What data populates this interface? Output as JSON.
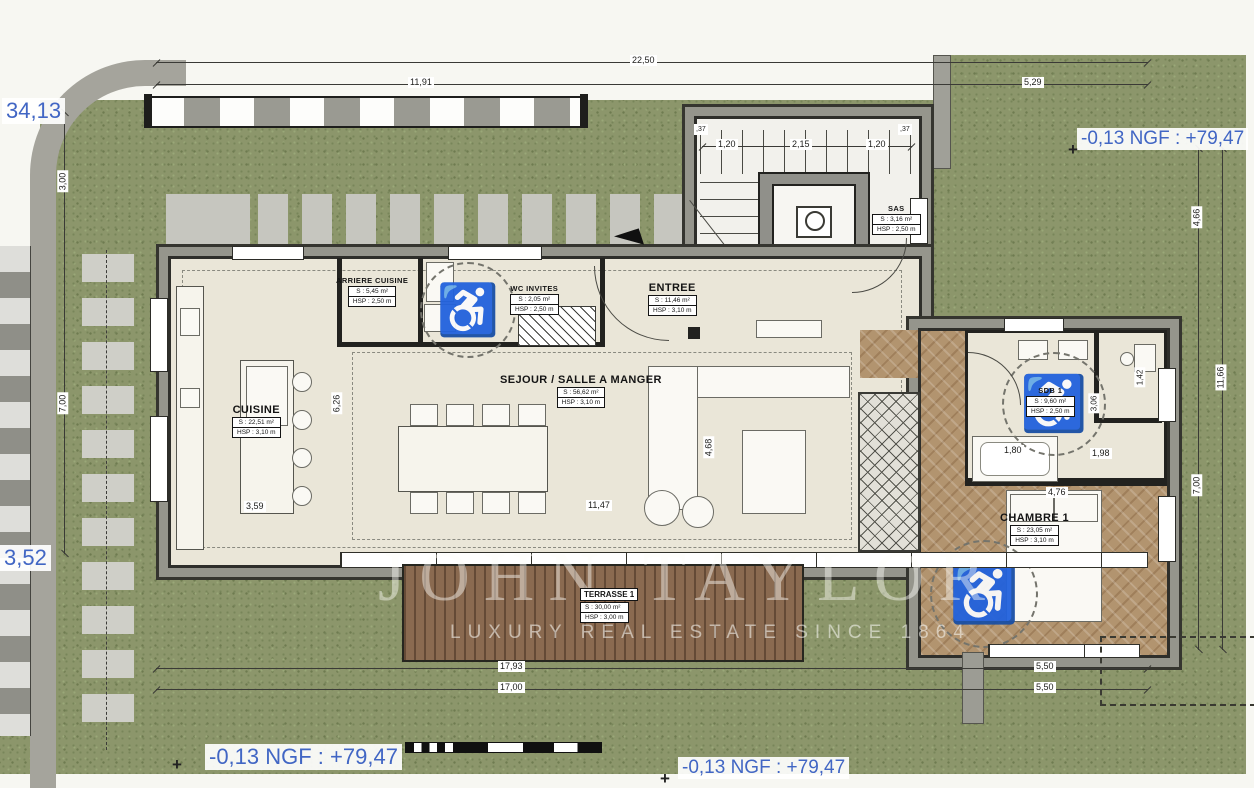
{
  "watermark": {
    "brand": "JOHN TAYLOR",
    "tagline": "LUXURY REAL ESTATE SINCE 1864"
  },
  "elevation": {
    "top_right": "-0,13 NGF : +79,47",
    "bottom_left": "-0,13 NGF : +79,47",
    "bottom_right": "-0,13 NGF : +79,47"
  },
  "boundary": {
    "left_top": "34,13",
    "left_bottom": "3,52"
  },
  "rooms": {
    "arriere_cuisine": {
      "name": "ARRIERE CUISINE",
      "area": "S : 5,45 m²",
      "hsp": "HSP : 2,50 m"
    },
    "wc_invites": {
      "name": "WC INVITES",
      "area": "S : 2,05 m²",
      "hsp": "HSP : 2,50 m"
    },
    "entree": {
      "name": "ENTREE",
      "area": "S : 11,46 m²",
      "hsp": "HSP : 3,10 m"
    },
    "sas": {
      "name": "SAS",
      "area": "S : 3,16 m²",
      "hsp": "HSP : 2,50 m"
    },
    "cuisine": {
      "name": "CUISINE",
      "area": "S : 22,51 m²",
      "hsp": "HSP : 3,10 m"
    },
    "sejour": {
      "name": "SEJOUR / SALLE A MANGER",
      "area": "S : 56,62 m²",
      "hsp": "HSP : 3,10 m"
    },
    "sdb1": {
      "name": "SDB 1",
      "area": "S : 9,60 m²",
      "hsp": "HSP : 2,50 m"
    },
    "chambre1": {
      "name": "CHAMBRE 1",
      "area": "S : 23,05 m²",
      "hsp": "HSP : 3,10 m"
    },
    "terrasse1": {
      "name": "TERRASSE 1",
      "area": "S : 30,00 m²",
      "hsp": "HSP : 3,00 m"
    }
  },
  "dims": {
    "t2250": "22,50",
    "t1191": "11,91",
    "t529": "5,29",
    "l300": "3,00",
    "l700": "7,00",
    "r466": "4,66",
    "r1166": "11,66",
    "r700": "7,00",
    "b1793": "17,93",
    "b550a": "5,50",
    "b1700": "17,00",
    "b550b": "5,50",
    "s120a": "1,20",
    "s215": "2,15",
    "s120b": "1,20",
    "w37a": ",37",
    "w37b": ",37",
    "i1147": "11,47",
    "i359": "3,59",
    "i626": "6,26",
    "i468": "4,68",
    "i476": "4,76",
    "i180": "1,80",
    "i198": "1,98",
    "i306": "3,06",
    "i142": "1,42"
  },
  "colors": {
    "grass": "#8c966b",
    "floor": "#eae6d8",
    "parquet": "#b2946f",
    "deck": "#8a6a50",
    "wall": "#95958c",
    "elevation_blue": "#4166c4"
  }
}
